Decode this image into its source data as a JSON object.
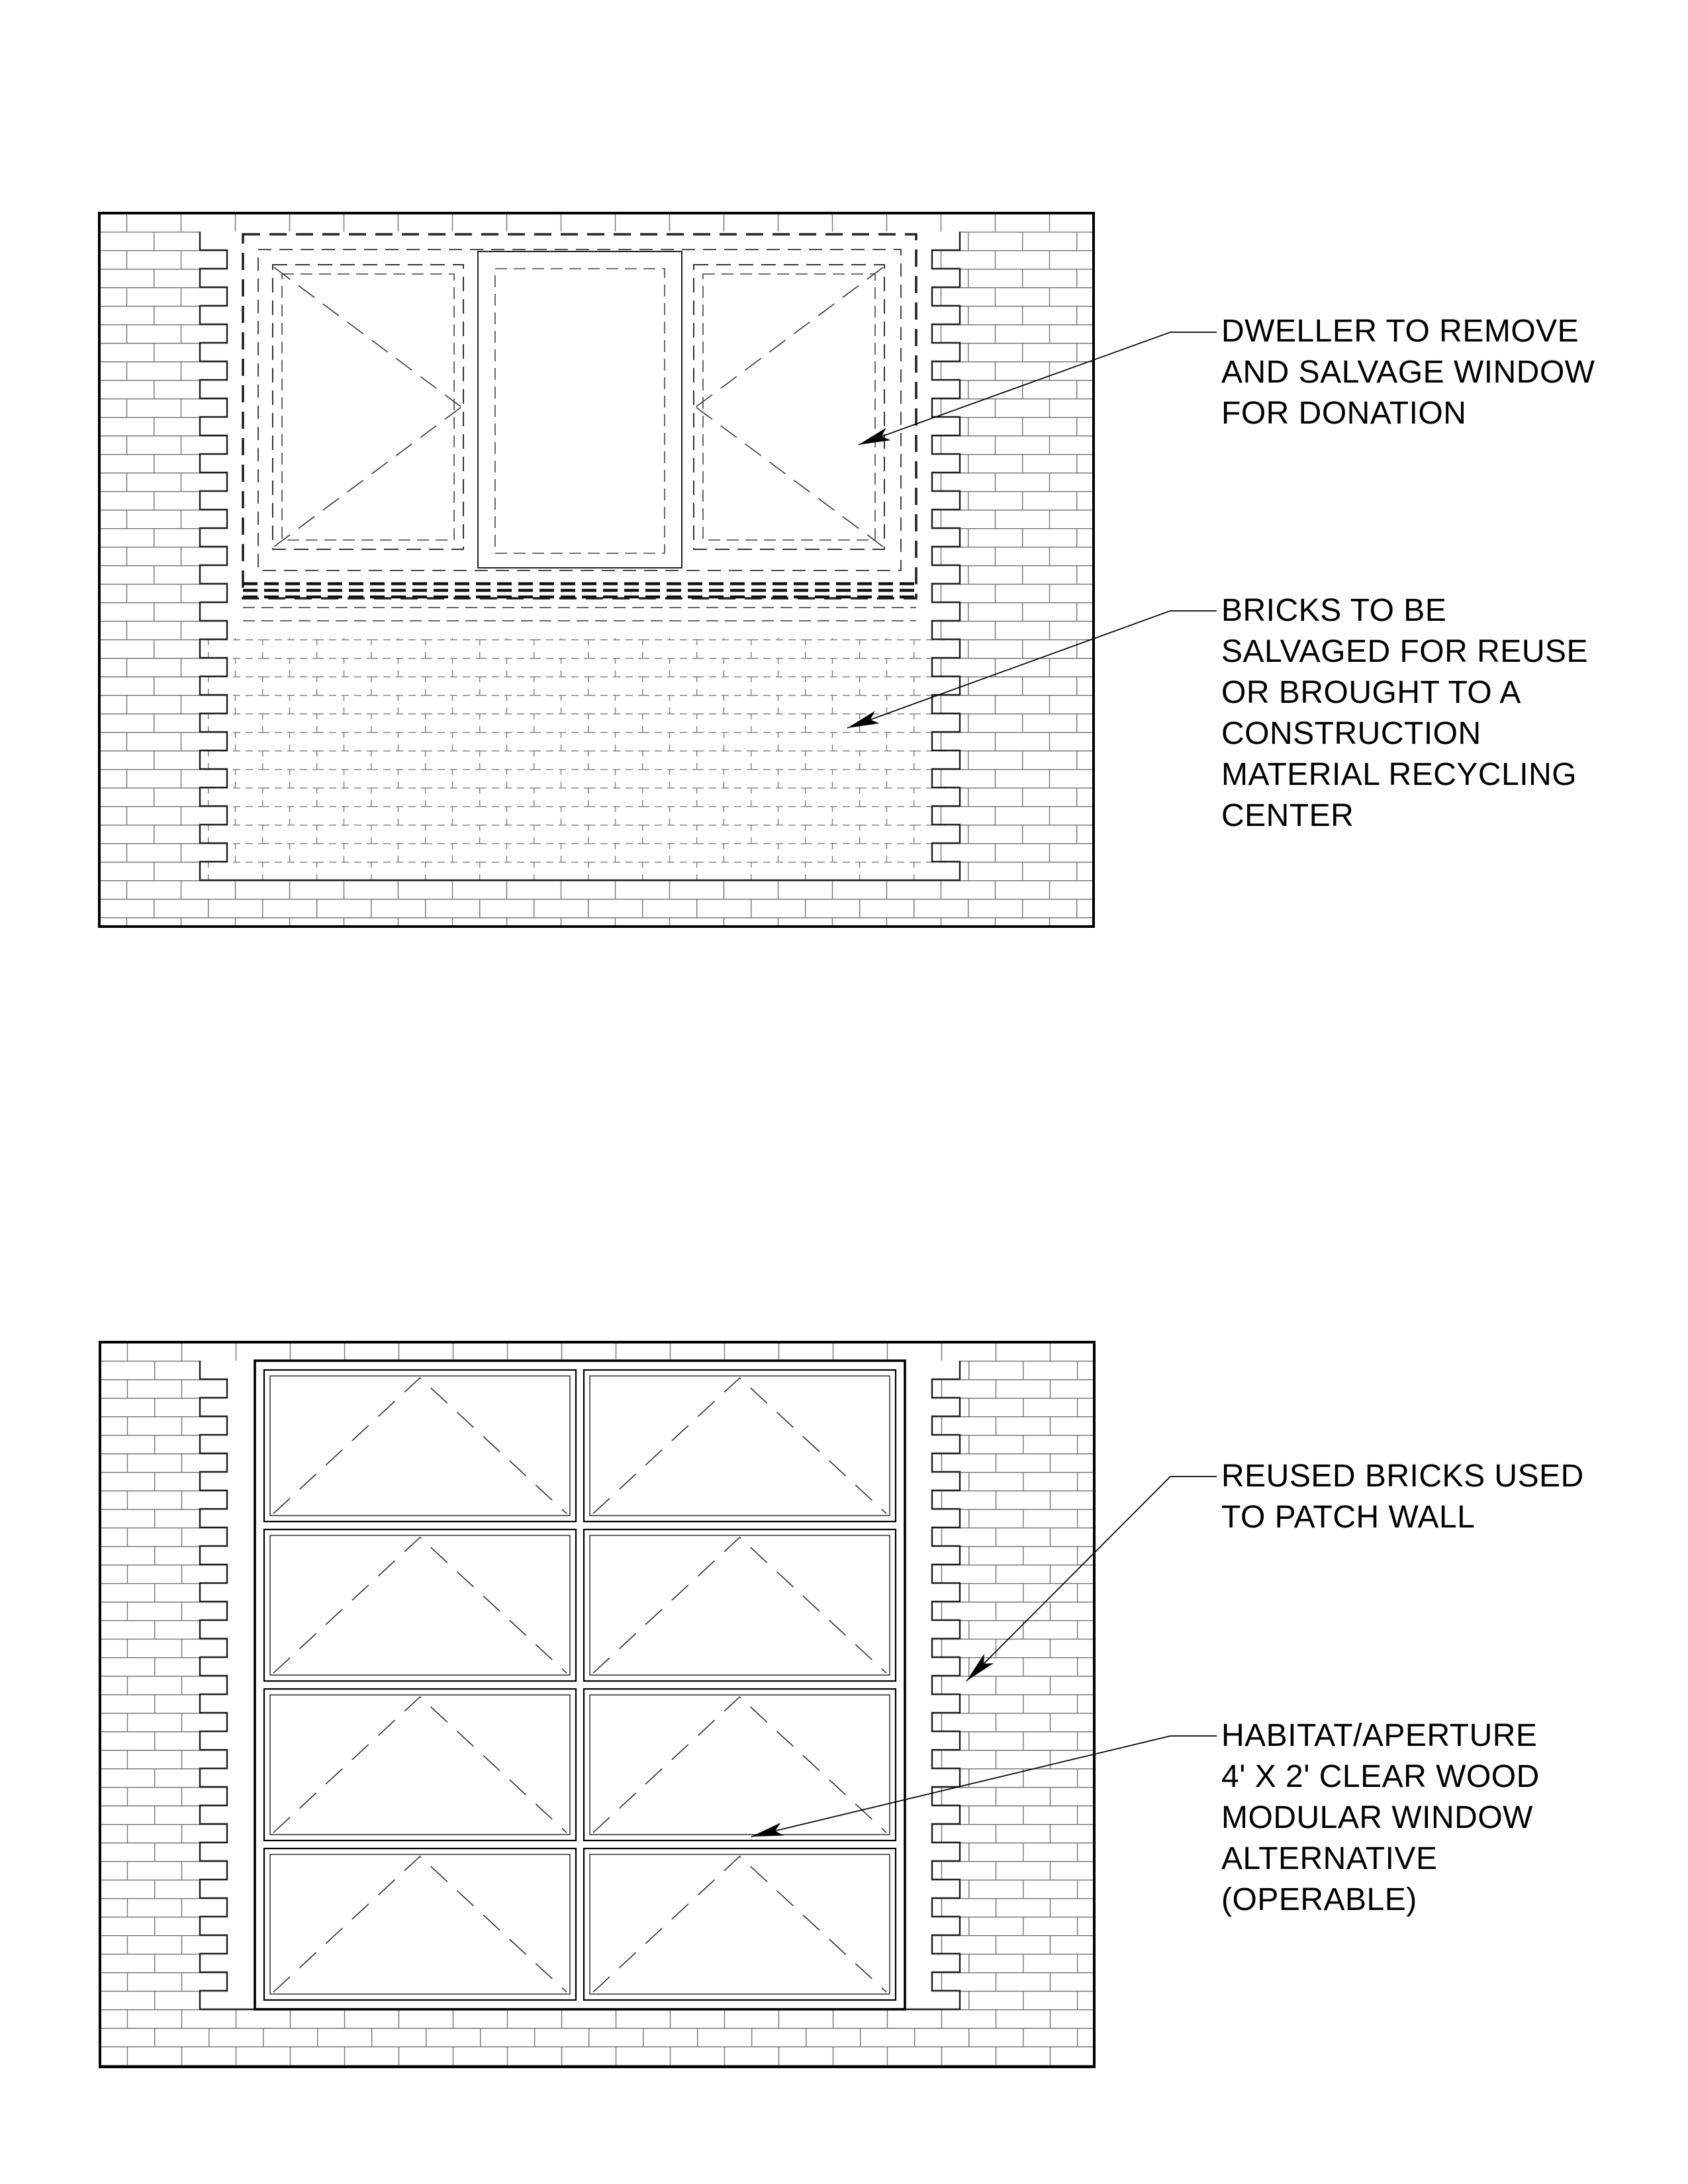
{
  "sheet": {
    "background": "#ffffff",
    "ink_color": "#000000",
    "brick_line_color": "#6f6f6f",
    "dashed_brick_color": "#7d7d7d"
  },
  "figures": {
    "existing_wall": {
      "name": "existing wall elevation with window to be removed",
      "features": [
        "brick wall",
        "dashed salvage window (two casements + fixed center)",
        "dashed bricks to be salvaged",
        "toothed brick edges"
      ]
    },
    "patched_wall": {
      "name": "patched wall elevation with modular window grid",
      "features": [
        "brick wall",
        "2 x 4 grid of operable awning windows",
        "toothed brick edges"
      ]
    }
  },
  "annotations": [
    {
      "id": "window-salvage",
      "text": "DWELLER TO REMOVE\nAND SALVAGE WINDOW\nFOR DONATION"
    },
    {
      "id": "bricks-salvage",
      "text": "BRICKS TO BE\nSALVAGED FOR REUSE\nOR BROUGHT TO A\nCONSTRUCTION\nMATERIAL RECYCLING\nCENTER"
    },
    {
      "id": "reused-bricks",
      "text": "REUSED BRICKS USED\nTO PATCH WALL"
    },
    {
      "id": "modular-window",
      "text": "HABITAT/APERTURE\n4' X 2' CLEAR WOOD\nMODULAR WINDOW\nALTERNATIVE\n(OPERABLE)"
    }
  ]
}
